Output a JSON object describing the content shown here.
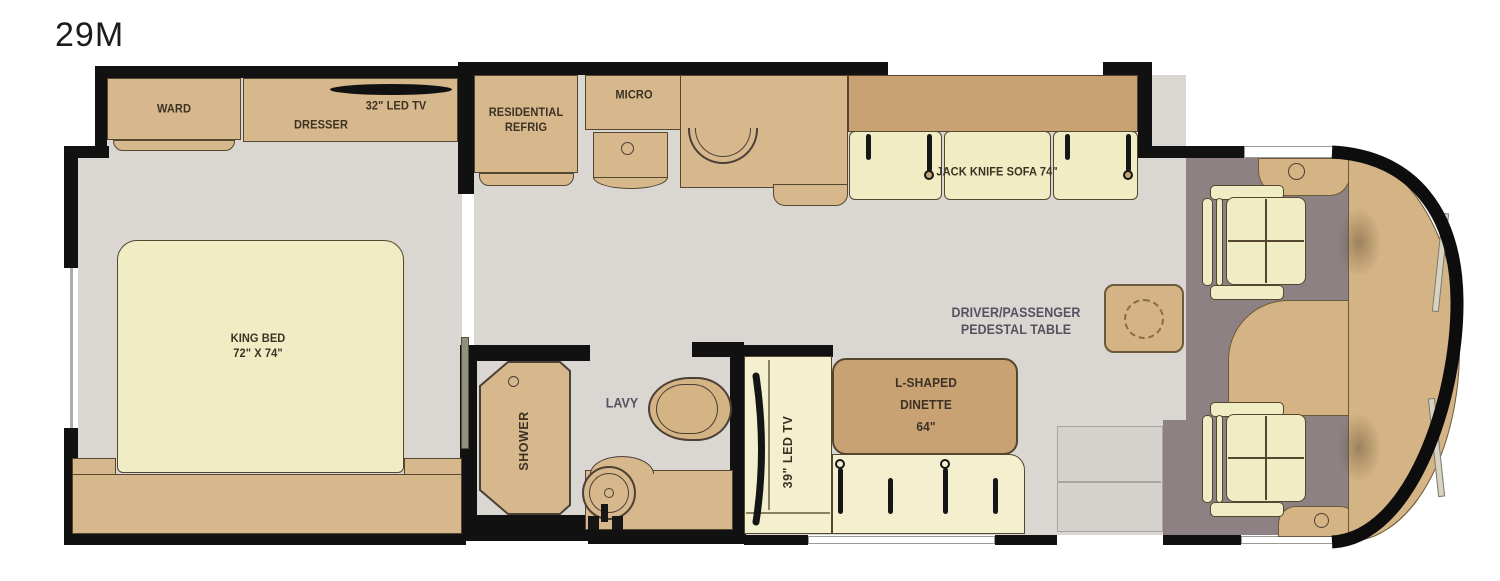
{
  "title": "29M",
  "colors": {
    "cabinet_tan": "#d7b88c",
    "accent_tan": "#c9a273",
    "dash_tan": "#d4b384",
    "cushion_cream": "#f0ecc3",
    "bench_cream": "#f4f0cf",
    "floor_gray": "#dad6d2",
    "cab_floor_taupe": "#8e8184",
    "wall_black": "#111111",
    "label_brown": "#3c3224",
    "label_blue": "#53535f"
  },
  "bedroom": {
    "ward": "WARD",
    "dresser": "DRESSER",
    "tv": "32\" LED TV",
    "bed_name": "KING BED",
    "bed_size": "72\" X 74\""
  },
  "kitchen": {
    "refrig_line1": "RESIDENTIAL",
    "refrig_line2": "REFRIG",
    "micro": "MICRO"
  },
  "living": {
    "sofa": "JACK KNIFE SOFA 74\""
  },
  "bath": {
    "shower": "SHOWER",
    "lavy": "LAVY"
  },
  "dinette": {
    "tv": "39\" LED TV",
    "label_line1": "L-SHAPED",
    "label_line2": "DINETTE",
    "label_line3": "64\""
  },
  "cab": {
    "table_line1": "DRIVER/PASSENGER",
    "table_line2": "PEDESTAL TABLE"
  }
}
